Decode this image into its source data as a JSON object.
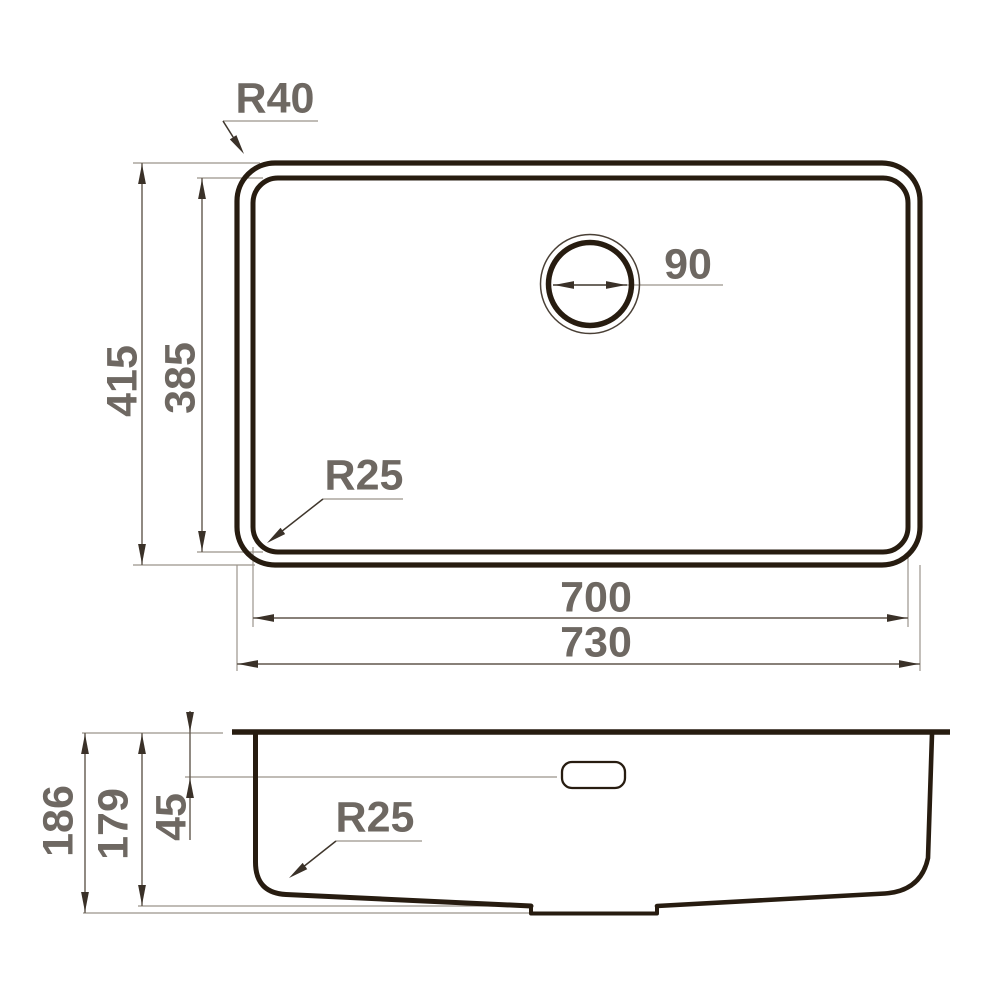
{
  "drawing": {
    "type": "technical-dimension-drawing",
    "subject": "undermount kitchen sink, top view and side section view",
    "units_shown": "none (plain numbers, mm implied by convention)"
  },
  "colors": {
    "background": "#ffffff",
    "outline": "#271c10",
    "dimension_line": "#60574d",
    "extension_line": "#9b948b",
    "arrowhead": "#3a3128",
    "label_text": "#6e6862"
  },
  "views": {
    "top": {
      "name": "top view",
      "labels": {
        "corner_radius_outer": "R40",
        "drain_diameter": "90",
        "outer_height": "415",
        "inner_height": "385",
        "corner_radius_inner": "R25",
        "inner_width": "700",
        "outer_width": "730"
      }
    },
    "section": {
      "name": "side section view",
      "labels": {
        "total_depth": "186",
        "bowl_depth": "179",
        "overflow_drop": "45",
        "bottom_corner_radius": "R25"
      }
    }
  }
}
